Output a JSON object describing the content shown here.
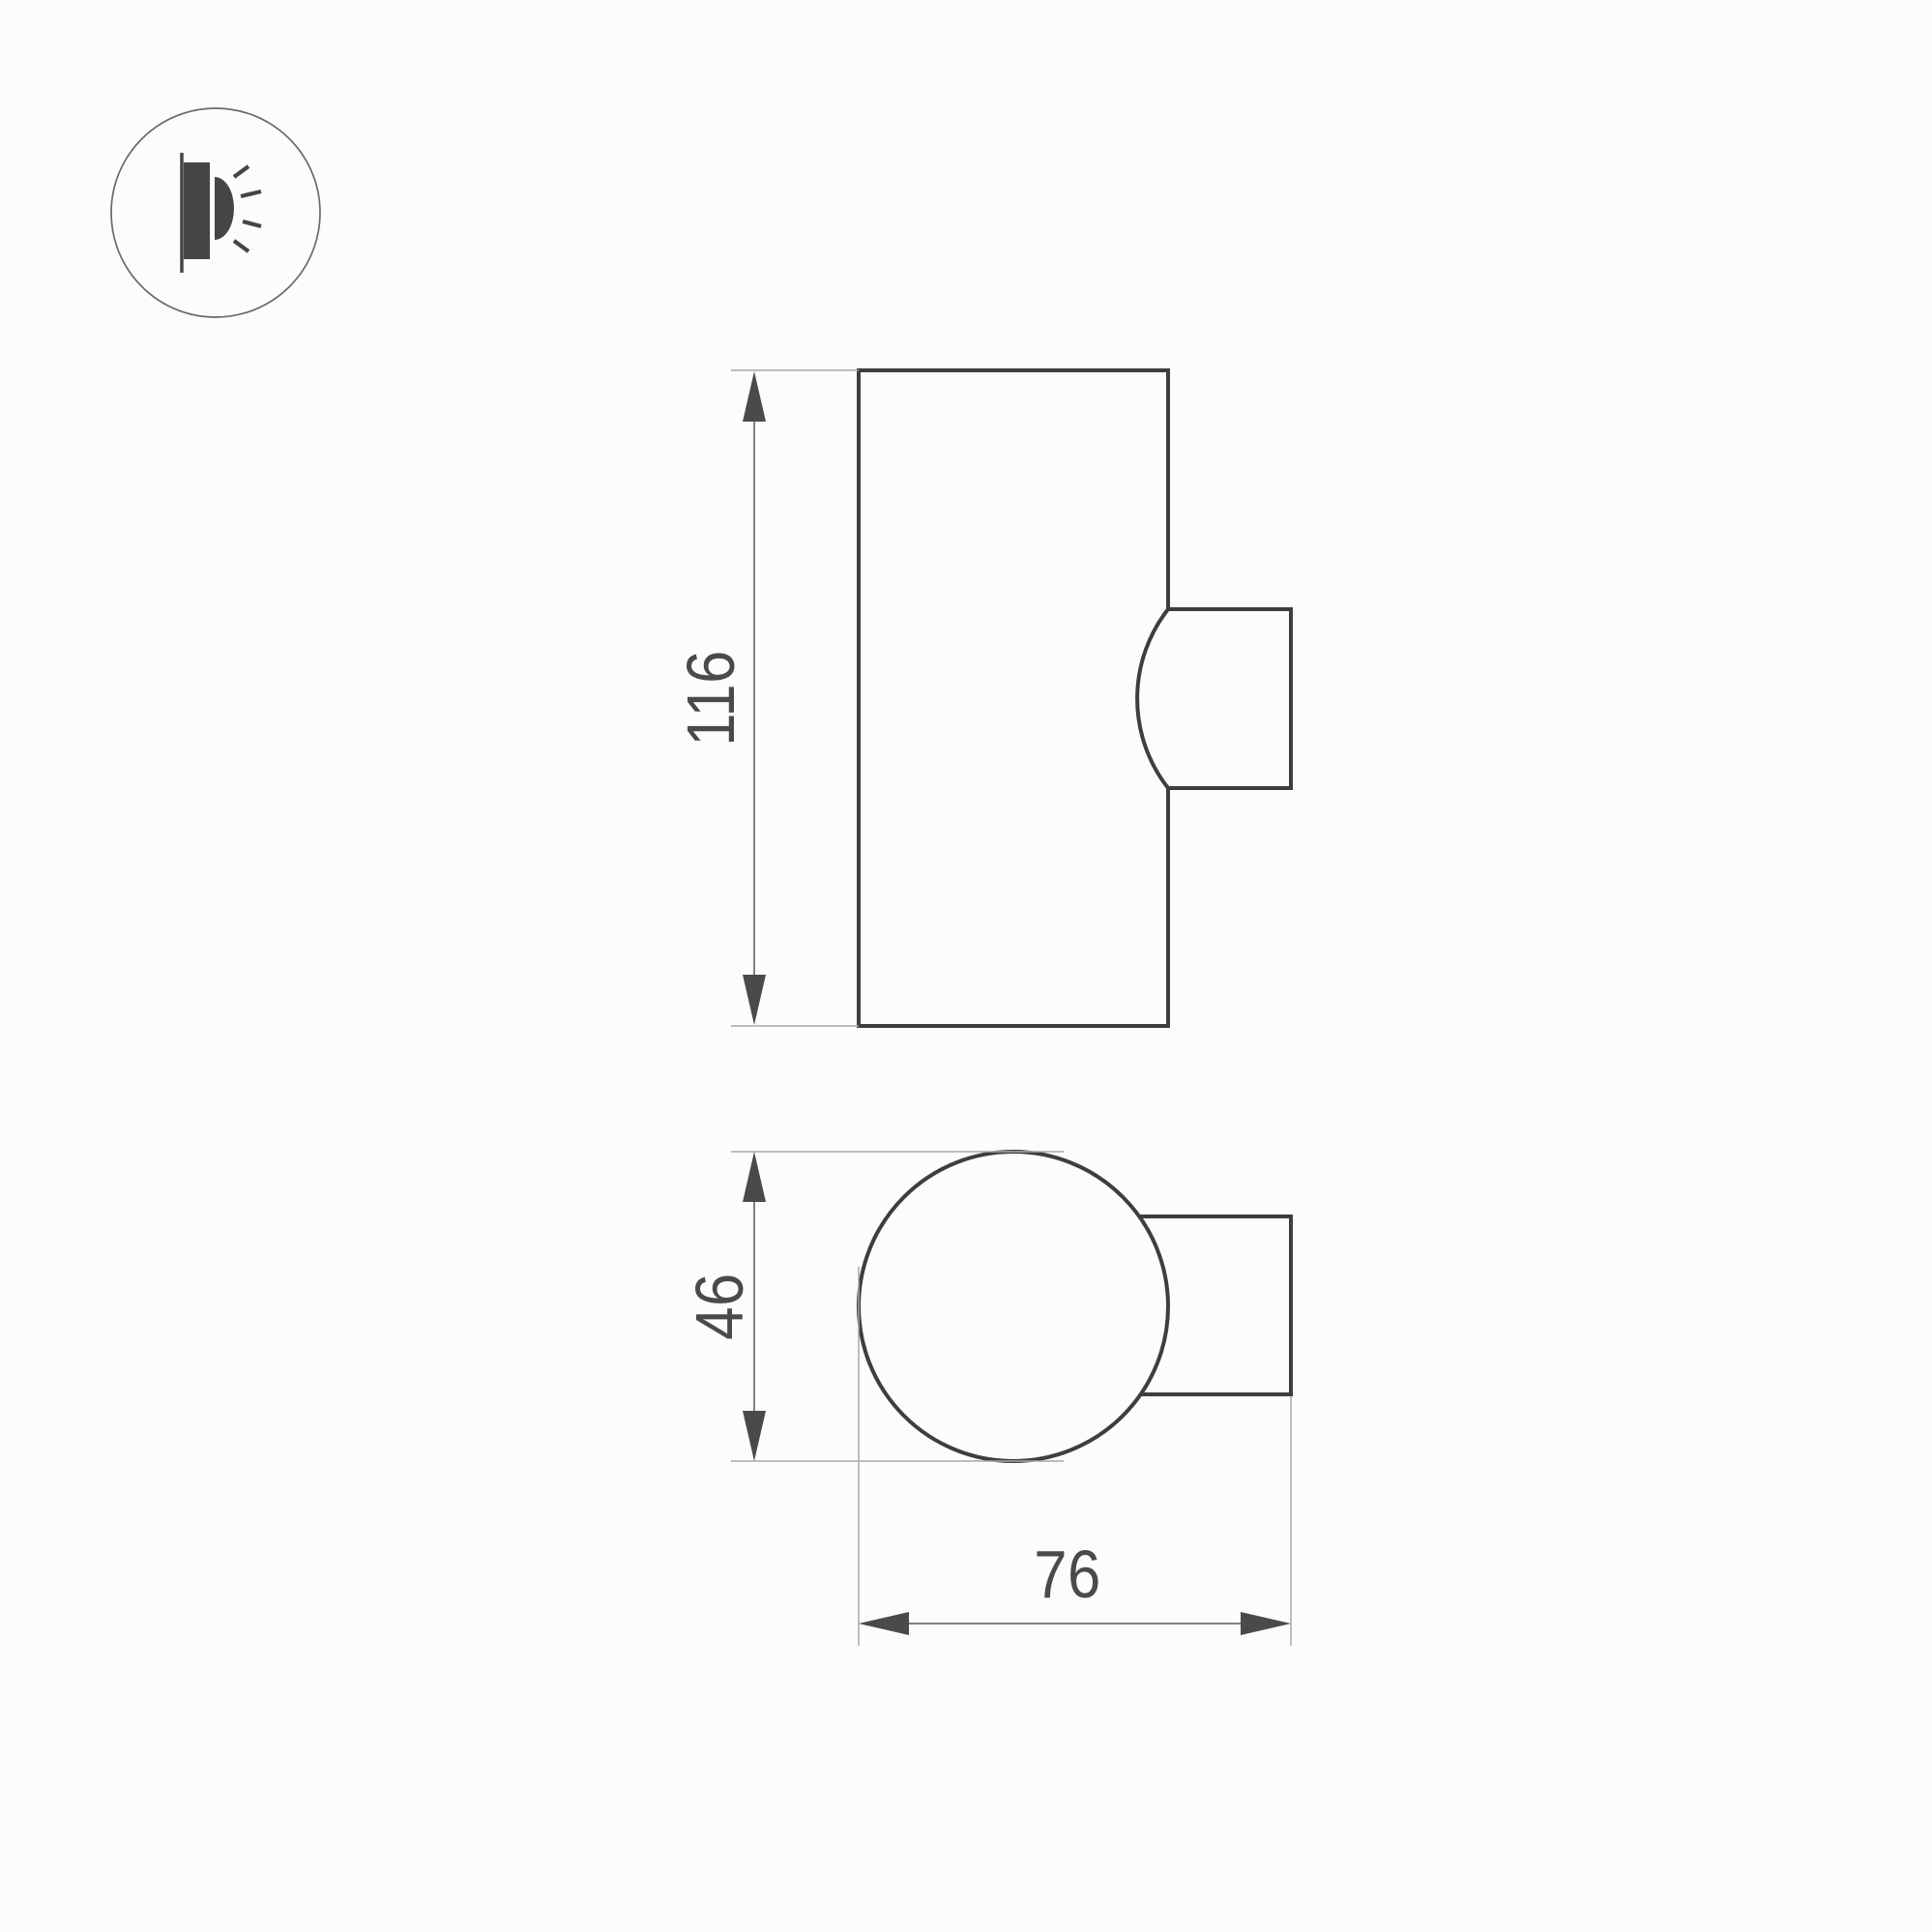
{
  "document": {
    "kind": "technical-dimension-drawing",
    "subject": "wall-mounted cylindrical luminaire, two orthographic views"
  },
  "colors": {
    "background": "#fcfcfc",
    "outline": "#3e3e3e",
    "dimension_line": "#6e6e6e",
    "extension_line": "#a8a8a8",
    "text": "#4a4a4a",
    "icon": "#454545",
    "icon_circle": "#6a6a6a"
  },
  "legend": {
    "icon": "wall-light-icon"
  },
  "dimensions": {
    "front_height": "116",
    "top_height": "46",
    "top_width": "76"
  }
}
